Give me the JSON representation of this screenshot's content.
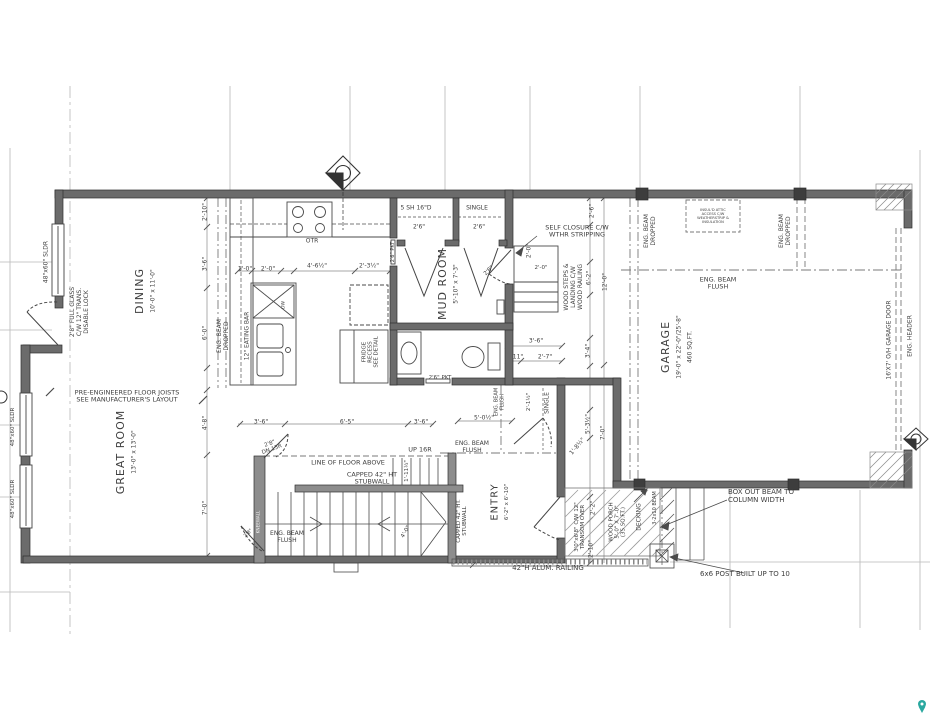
{
  "plan": {
    "colors": {
      "wall": "#6b6b6b",
      "stubwall": "#8d8d8d",
      "line": "#4a4a4a",
      "dash": "#7a7a7a",
      "grid": "#b8b8b8",
      "text": "#3d3d3d",
      "pin": "#2aa8a0"
    },
    "labels": [
      {
        "id": "sldr-dining",
        "text": "48\"x60\" SLDR",
        "x": 47,
        "y": 262,
        "rot": -90,
        "fs": 6
      },
      {
        "id": "dining-door-note",
        "text": "2'8\" FULL GLASS\nC/W 12\" TRANS.\nDISABLE LOCK",
        "x": 80,
        "y": 312,
        "rot": -90,
        "fs": 6
      },
      {
        "id": "room-dining",
        "text": "DINING",
        "x": 140,
        "y": 291,
        "rot": -90,
        "fs": 11,
        "ls": 1
      },
      {
        "id": "dining-dims",
        "text": "10'-0\" x 11'-0\"",
        "x": 154,
        "y": 291,
        "rot": -90,
        "fs": 6
      },
      {
        "id": "dim-2-10-top",
        "text": "2'-10\"",
        "x": 206,
        "y": 212,
        "rot": -90,
        "fs": 6
      },
      {
        "id": "dim-3-6-left",
        "text": "3'-6\"",
        "x": 206,
        "y": 264,
        "rot": -90,
        "fs": 6
      },
      {
        "id": "dim-6-0-left",
        "text": "6'-0\"",
        "x": 206,
        "y": 333,
        "rot": -90,
        "fs": 6
      },
      {
        "id": "beam-dropped-kitchen",
        "text": "ENG. BEAM\nDROPPED",
        "x": 224,
        "y": 336,
        "rot": -90,
        "fs": 6
      },
      {
        "id": "eating-bar",
        "text": "12\" EATING BAR",
        "x": 248,
        "y": 336,
        "rot": -90,
        "fs": 6
      },
      {
        "id": "dw",
        "text": "DW",
        "x": 284,
        "y": 305,
        "rot": -90,
        "fs": 4.5
      },
      {
        "id": "dim-1-0",
        "text": "1'-0\"",
        "x": 245,
        "y": 270,
        "rot": 0,
        "fs": 6
      },
      {
        "id": "dim-2-0-kitchen",
        "text": "2'-0\"",
        "x": 268,
        "y": 270,
        "rot": 0,
        "fs": 6
      },
      {
        "id": "dim-4-6h",
        "text": "4'-6½\"",
        "x": 317,
        "y": 267,
        "rot": 0,
        "fs": 6
      },
      {
        "id": "dim-2-3h",
        "text": "2'-3½\"",
        "x": 369,
        "y": 267,
        "rot": 0,
        "fs": 6
      },
      {
        "id": "otr",
        "text": "OTR",
        "x": 312,
        "y": 242,
        "rot": 0,
        "fs": 6
      },
      {
        "id": "shelf-closet",
        "text": "5 SH 16\"D",
        "x": 416,
        "y": 209,
        "rot": 0,
        "fs": 6
      },
      {
        "id": "single-closet-top",
        "text": "SINGLE",
        "x": 477,
        "y": 209,
        "rot": 0,
        "fs": 6
      },
      {
        "id": "door-2-6-a",
        "text": "2'6\"",
        "x": 419,
        "y": 228,
        "rot": 0,
        "fs": 6
      },
      {
        "id": "door-2-6-b",
        "text": "2'6\"",
        "x": 479,
        "y": 228,
        "rot": 0,
        "fs": 6
      },
      {
        "id": "pkt-kitchen",
        "text": "2'6\" PKT",
        "x": 394,
        "y": 252,
        "rot": -90,
        "fs": 5
      },
      {
        "id": "room-mudroom",
        "text": "MUD ROOM",
        "x": 443,
        "y": 284,
        "rot": -90,
        "fs": 11,
        "ls": 1
      },
      {
        "id": "mudroom-dims",
        "text": "5'-10\" x 7'-3\"",
        "x": 457,
        "y": 284,
        "rot": -90,
        "fs": 6
      },
      {
        "id": "self-closure",
        "text": "SELF CLOSURE C/W\nWTHR STRIPPING",
        "x": 577,
        "y": 232,
        "rot": 0,
        "fs": 6.5
      },
      {
        "id": "wood-steps",
        "text": "WOOD STEPS &\nLANDING C/W\nWOOD RAILING",
        "x": 574,
        "y": 287,
        "rot": -90,
        "fs": 6
      },
      {
        "id": "dim-2-6-right",
        "text": "2'-6\"",
        "x": 593,
        "y": 211,
        "rot": -90,
        "fs": 6
      },
      {
        "id": "dim-2-0-steps",
        "text": "2'-0\"",
        "x": 530,
        "y": 251,
        "rot": -90,
        "fs": 6
      },
      {
        "id": "dim-2-0-steps2",
        "text": "2'-0\"",
        "x": 541,
        "y": 268,
        "rot": 0,
        "fs": 5.5
      },
      {
        "id": "dim-6-2-right",
        "text": "6'-2\"",
        "x": 590,
        "y": 278,
        "rot": -90,
        "fs": 6
      },
      {
        "id": "dim-12-0",
        "text": "12'-0\"",
        "x": 606,
        "y": 282,
        "rot": -90,
        "fs": 6
      },
      {
        "id": "beam-dropped-garage-l",
        "text": "ENG. BEAM\nDROPPED",
        "x": 651,
        "y": 231,
        "rot": -90,
        "fs": 6
      },
      {
        "id": "attic-note",
        "text": "INSUL'D ATTIC\nACCESS C/W\nWEATHERSTRIP &\nINSULATION",
        "x": 713,
        "y": 216,
        "rot": 0,
        "fs": 3.6
      },
      {
        "id": "beam-dropped-garage-r",
        "text": "ENG. BEAM\nDROPPED",
        "x": 786,
        "y": 231,
        "rot": -90,
        "fs": 6
      },
      {
        "id": "beam-flush-garage",
        "text": "ENG. BEAM\nFLUSH",
        "x": 718,
        "y": 284,
        "rot": 0,
        "fs": 6.5
      },
      {
        "id": "room-garage",
        "text": "GARAGE",
        "x": 666,
        "y": 347,
        "rot": -90,
        "fs": 11,
        "ls": 1
      },
      {
        "id": "garage-dims",
        "text": "19'-0\" x 22'-0\"/25'-8\"",
        "x": 680,
        "y": 347,
        "rot": -90,
        "fs": 6
      },
      {
        "id": "garage-area",
        "text": "460 SQ.FT.",
        "x": 691,
        "y": 347,
        "rot": -90,
        "fs": 6
      },
      {
        "id": "garage-door-label",
        "text": "16'X7' O/H GARAGE DOOR",
        "x": 890,
        "y": 340,
        "rot": -90,
        "fs": 6
      },
      {
        "id": "eng-header",
        "text": "ENG. HEADER",
        "x": 911,
        "y": 336,
        "rot": -90,
        "fs": 6
      },
      {
        "id": "door-2-8-mud",
        "text": "2'8\"",
        "x": 489,
        "y": 271,
        "rot": -45,
        "fs": 5.5
      },
      {
        "id": "beam-flush-closet",
        "text": "ENG. BEAM\nFLUSH",
        "x": 500,
        "y": 402,
        "rot": -90,
        "fs": 5
      },
      {
        "id": "dim-2-1h",
        "text": "2'-1½\"",
        "x": 529,
        "y": 402,
        "rot": -90,
        "fs": 5.5
      },
      {
        "id": "single-closet-entry",
        "text": "SINGLE",
        "x": 548,
        "y": 403,
        "rot": -90,
        "fs": 6
      },
      {
        "id": "dim-5-0h",
        "text": "5'-0½\"",
        "x": 484,
        "y": 419,
        "rot": 0,
        "fs": 6
      },
      {
        "id": "dim-3-6-closet",
        "text": "3'-6\"",
        "x": 536,
        "y": 342,
        "rot": 0,
        "fs": 6
      },
      {
        "id": "dim-11",
        "text": "11\"",
        "x": 518,
        "y": 358,
        "rot": 0,
        "fs": 6
      },
      {
        "id": "dim-2-7",
        "text": "2'-7\"",
        "x": 545,
        "y": 358,
        "rot": 0,
        "fs": 6
      },
      {
        "id": "dim-3-4",
        "text": "3'-4\"",
        "x": 589,
        "y": 351,
        "rot": -90,
        "fs": 6
      },
      {
        "id": "dim-5-3h",
        "text": "5'-3½\"",
        "x": 589,
        "y": 424,
        "rot": -90,
        "fs": 6
      },
      {
        "id": "dim-7-0-right",
        "text": "7'-0\"",
        "x": 604,
        "y": 433,
        "rot": -90,
        "fs": 6
      },
      {
        "id": "dim-1-8h",
        "text": "1'-8½\"",
        "x": 578,
        "y": 447,
        "rot": -50,
        "fs": 6
      },
      {
        "id": "beam-flush-entry",
        "text": "ENG. BEAM\nFLUSH",
        "x": 472,
        "y": 448,
        "rot": 0,
        "fs": 6
      },
      {
        "id": "room-entry",
        "text": "ENTRY",
        "x": 495,
        "y": 502,
        "rot": -90,
        "fs": 10,
        "ls": 1
      },
      {
        "id": "entry-dims",
        "text": "6'-2\" x 6'-10\"",
        "x": 507,
        "y": 502,
        "rot": -90,
        "fs": 5.5
      },
      {
        "id": "capped-stub-v",
        "text": "CAPPED 42\" HT.\nSTUBWALL",
        "x": 462,
        "y": 521,
        "rot": -90,
        "fs": 5.5
      },
      {
        "id": "up-16r",
        "text": "UP 16R",
        "x": 420,
        "y": 450,
        "rot": 0,
        "fs": 6.5
      },
      {
        "id": "line-floor-above",
        "text": "LINE OF FLOOR ABOVE",
        "x": 348,
        "y": 463,
        "rot": 0,
        "fs": 6.5
      },
      {
        "id": "capped-stub-h",
        "text": "CAPPED 42\" HT\nSTUBWALL",
        "x": 372,
        "y": 479,
        "rot": 0,
        "fs": 6.5
      },
      {
        "id": "dn-15r",
        "text": "2'8\"\nDN 15R",
        "x": 271,
        "y": 447,
        "rot": -20,
        "fs": 5.5
      },
      {
        "id": "beam-flush-stairs",
        "text": "ENG. BEAM\nFLUSH",
        "x": 287,
        "y": 538,
        "rot": 0,
        "fs": 6
      },
      {
        "id": "kneewall",
        "text": "KNEEWALL",
        "x": 259,
        "y": 522,
        "rot": -90,
        "fs": 4.2,
        "color": "#f0f0f0"
      },
      {
        "id": "joists-note",
        "text": "PRE-ENGINEERED FLOOR JOISTS\nSEE MANUFACTURER'S LAYOUT",
        "x": 127,
        "y": 397,
        "rot": 0,
        "fs": 6.5
      },
      {
        "id": "room-greatroom",
        "text": "GREAT ROOM",
        "x": 121,
        "y": 452,
        "rot": -90,
        "fs": 11,
        "ls": 1
      },
      {
        "id": "greatroom-dims",
        "text": "13'-0\" x 13'-0\"",
        "x": 135,
        "y": 452,
        "rot": -90,
        "fs": 6
      },
      {
        "id": "sldr-gr-1",
        "text": "48\"x60\" SLDR",
        "x": 13,
        "y": 427,
        "rot": -90,
        "fs": 5.5
      },
      {
        "id": "sldr-gr-2",
        "text": "48\"x60\" SLDR",
        "x": 13,
        "y": 499,
        "rot": -90,
        "fs": 5.5
      },
      {
        "id": "dim-4-8",
        "text": "4'-8\"",
        "x": 206,
        "y": 423,
        "rot": -90,
        "fs": 6
      },
      {
        "id": "dim-7-0-left",
        "text": "7'-0\"",
        "x": 206,
        "y": 508,
        "rot": -90,
        "fs": 6
      },
      {
        "id": "dim-3-6-a",
        "text": "3'-6\"",
        "x": 261,
        "y": 423,
        "rot": 0,
        "fs": 6
      },
      {
        "id": "dim-6-5",
        "text": "6'-5\"",
        "x": 347,
        "y": 423,
        "rot": 0,
        "fs": 6
      },
      {
        "id": "dim-3-6-b",
        "text": "3'-6\"",
        "x": 421,
        "y": 423,
        "rot": 0,
        "fs": 6
      },
      {
        "id": "dim-1-11h",
        "text": "1'-11½\"",
        "x": 407,
        "y": 471,
        "rot": -90,
        "fs": 5.5
      },
      {
        "id": "dim-4-0-winder",
        "text": "4'-0\"",
        "x": 406,
        "y": 532,
        "rot": -60,
        "fs": 5.5
      },
      {
        "id": "entry-door-note",
        "text": "3'0\"x6'8\" C/W 12\"\nTRANSOM OVER",
        "x": 580,
        "y": 527,
        "rot": -90,
        "fs": 5.5
      },
      {
        "id": "dim-2-2",
        "text": "2'-2\"",
        "x": 594,
        "y": 508,
        "rot": -90,
        "fs": 6
      },
      {
        "id": "dim-2-10-porch",
        "text": "2'-10\"",
        "x": 592,
        "y": 549,
        "rot": -90,
        "fs": 6
      },
      {
        "id": "wood-porch",
        "text": "WOOD PORCH\n5'-0\" X 7'-0\"\n(35 SQ.FT.)",
        "x": 618,
        "y": 522,
        "rot": -90,
        "fs": 5.5
      },
      {
        "id": "decking",
        "text": "DECKING",
        "x": 640,
        "y": 517,
        "rot": -90,
        "fs": 6
      },
      {
        "id": "beam-3-2x10",
        "text": "3-2x10 BEAM",
        "x": 656,
        "y": 508,
        "rot": -90,
        "fs": 5
      },
      {
        "id": "railing",
        "text": "42\"H ALUM. RAILING",
        "x": 548,
        "y": 569,
        "rot": 0,
        "fs": 7
      },
      {
        "id": "box-out-note",
        "text": "BOX OUT BEAM TO\nCOLUMN WIDTH",
        "x": 728,
        "y": 497,
        "rot": 0,
        "fs": 7,
        "anchor": "left"
      },
      {
        "id": "post-note",
        "text": "6x6 POST BUILT UP TO 10",
        "x": 700,
        "y": 575,
        "rot": 0,
        "fs": 7,
        "anchor": "left"
      },
      {
        "id": "pkt-bath",
        "text": "2'6\" PKT",
        "x": 440,
        "y": 378,
        "rot": 0,
        "fs": 5.5
      },
      {
        "id": "fridge-note",
        "text": "FRIDGE\nRECESS\nSEE DETAIL",
        "x": 371,
        "y": 352,
        "rot": -90,
        "fs": 5.5
      },
      {
        "id": "door-2-8-gr",
        "text": "2'8\"",
        "x": 249,
        "y": 534,
        "rot": -45,
        "fs": 5
      }
    ]
  }
}
